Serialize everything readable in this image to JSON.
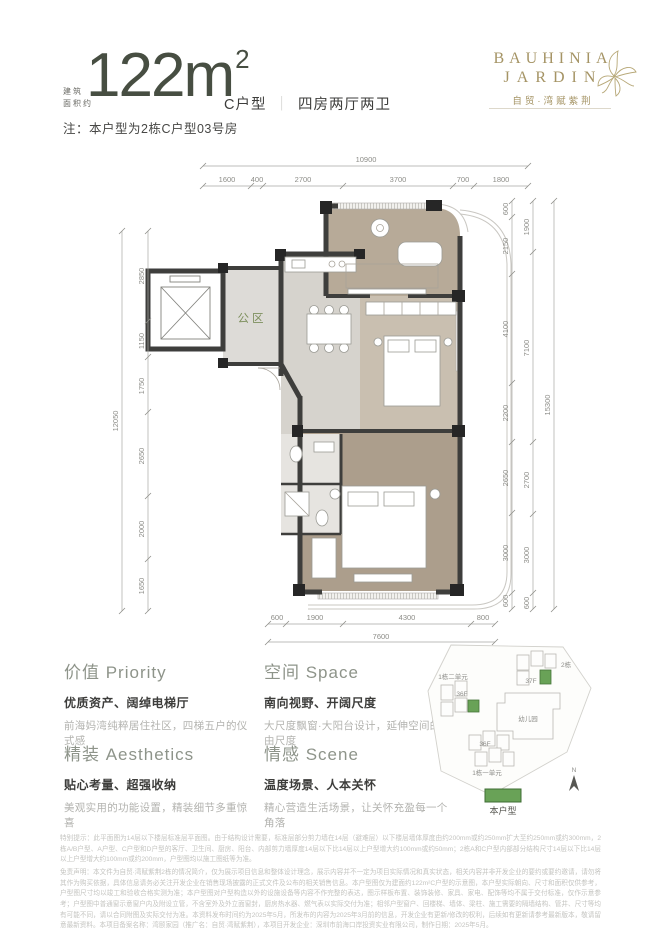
{
  "header": {
    "area_label_line1": "建筑",
    "area_label_line2": "面积约",
    "area_value": "122m",
    "area_sup": "2",
    "unit_type": "C户型",
    "divider": "｜",
    "unit_layout": "四房两厅两卫",
    "note": "注：本户型为2栋C户型03号房"
  },
  "logo": {
    "en_line1": "BAUHINIA",
    "en_line2": "JARDIN",
    "cn": "自贸·湾赋紫荆"
  },
  "floorplan": {
    "public_area": "公区",
    "dims": {
      "top_overall": "10900",
      "top": [
        "1600",
        "400",
        "2700",
        "3700",
        "700",
        "1800"
      ],
      "left_overall": "12050",
      "left": [
        "2850",
        "1150",
        "1750",
        "2650",
        "2000",
        "1650"
      ],
      "right_inner": [
        "600",
        "2150",
        "4100",
        "2200",
        "2650",
        "3000",
        "600"
      ],
      "right_mid": [
        "1900",
        "7100",
        "2700",
        "3000",
        "600"
      ],
      "right_overall": "15300",
      "bottom": [
        "600",
        "1900",
        "4300",
        "800"
      ],
      "bottom_overall": "7600"
    }
  },
  "features": {
    "col1": [
      {
        "title": "价值 Priority",
        "headline": "优质资产、阔绰电梯厅",
        "desc": "前海妈湾纯粹居住社区，四梯五户的仪式感"
      },
      {
        "title": "精装 Aesthetics",
        "headline": "贴心考量、超强收纳",
        "desc": "美观实用的功能设置，精装细节多重惊喜"
      }
    ],
    "col2": [
      {
        "title": "空间 Space",
        "headline": "南向视野、开阔尺度",
        "desc": "大尺度飘窗·大阳台设计，延伸空间的自由尺度"
      },
      {
        "title": "情感 Scene",
        "headline": "温度场景、人本关怀",
        "desc": "精心营造生活场景，让关怀充盈每一个角落"
      }
    ]
  },
  "siteplan": {
    "building2": "2栋",
    "b2_floors": "37F",
    "b1u2": "1栋二单元",
    "b1u2_floors": "36F",
    "kindergarten": "幼儿园",
    "b1u1": "1栋一单元",
    "b1u1_floors": "36F",
    "compass": "N",
    "legend": "本户型"
  },
  "disclaimer": {
    "p1": "特别提示：此平面图为14层以下楼层标准层平面图。由于结构设计需要，标准层部分剪力墙在14层（避难层）以下楼层墙体厚度由约200mm或约250mm扩大至约250mm或约300mm，2栋A/B户型、A户型、C户型和D户型的客厅、卫生间、厨房、阳台、内部剪力墙厚度14层以下比14层以上户型增大约100mm或约50mm；2栋A和C户型内部部分结构尺寸14层以下比14层以上户型增大约100mm或约200mm，户型图均以施工图纸等为准。",
    "p2": "免责声明：本文件为自贸·湾赋紫荆2栋的情况简介，仅为展示项目信息和整体设计理念，展示内容并不一定为项目实际情况和真实状态，相关内容并非开发企业的要约或要约邀请，请勿将其作为购买依据，具体信息请务必关注开发企业在销售现场披露的正式文件及公布的相关销售信息。本户型图仅为建面约122m²C户型的示意图，本户型实际朝向、尺寸和面积仅供参考，户型图尺寸均以竣工和验收合格实测为准；本户型图对户型构造以外的设施设备等内容不作完整的表达，图示样板布置、装饰装修、家具、家电、配饰等均不属于交付标准，仅作示意参考；户型图中普通窗示意窗户内及附设立管，不含室外及外立面窗封，厨房热水器、燃气表以实际交付为准；相邻户型窗户、回楼梯、墙体、梁柱、施工需要的隔墙结构、管井、尺寸等均有可能不同，请以合同附图及实际交付为准。本资料发布时间约为2025年5月，所发布的内容为2025年3月前的信息，开发企业有更新/修改的权利，后续如有更新请参考最新版本，敬请留意最新资料。本项目备案名称：湾颐家园（推广名：自贸·湾赋紫荆），本项目开发企业：深圳市前海口岸投资实业有限公司，制作日期：2025年5月。"
  },
  "colors": {
    "accent_gold": "#a59465",
    "plan_green": "#7e905e",
    "highlight_green": "#69a257",
    "wall": "#3e3e3c"
  }
}
